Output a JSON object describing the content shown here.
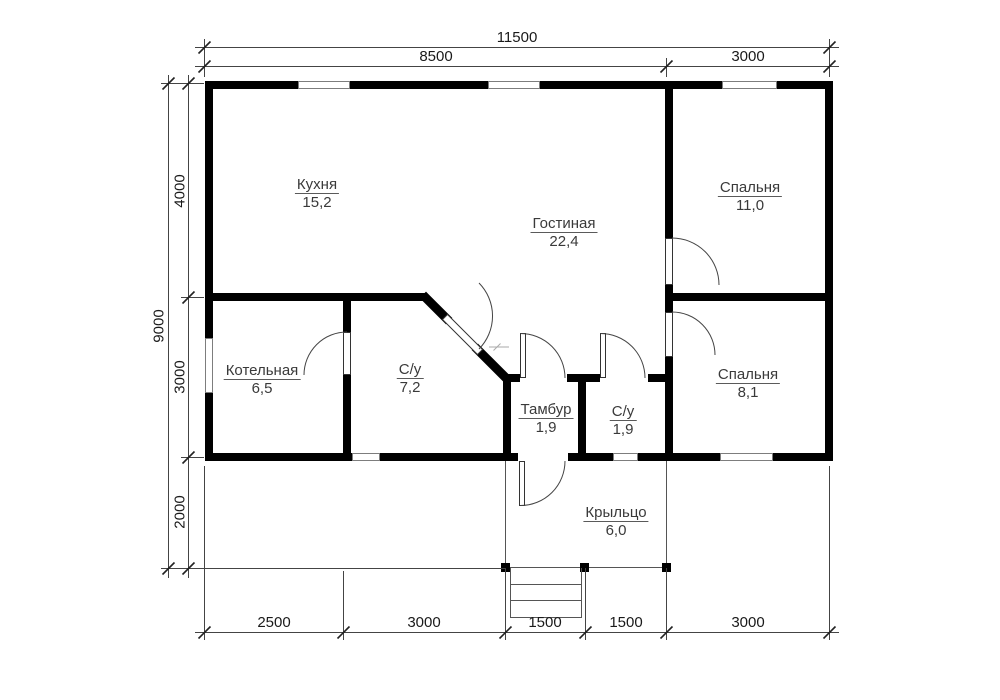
{
  "plan": {
    "rooms": [
      {
        "id": "kitchen",
        "name": "Кухня",
        "area": "15,2"
      },
      {
        "id": "living",
        "name": "Гостиная",
        "area": "22,4"
      },
      {
        "id": "bedroom1",
        "name": "Спальня",
        "area": "11,0"
      },
      {
        "id": "boiler",
        "name": "Котельная",
        "area": "6,5"
      },
      {
        "id": "bath1",
        "name": "С/у",
        "area": "7,2"
      },
      {
        "id": "tambour",
        "name": "Тамбур",
        "area": "1,9"
      },
      {
        "id": "bath2",
        "name": "С/у",
        "area": "1,9"
      },
      {
        "id": "bedroom2",
        "name": "Спальня",
        "area": "8,1"
      },
      {
        "id": "porch",
        "name": "Крыльцо",
        "area": "6,0"
      }
    ],
    "dims": {
      "total_width": "11500",
      "width_segments": [
        "8500",
        "3000"
      ],
      "total_height": "9000",
      "height_segments": [
        "4000",
        "3000",
        "2000"
      ],
      "bottom_segments": [
        "2500",
        "3000",
        "1500",
        "1500",
        "3000"
      ]
    },
    "colors": {
      "wall": "#000000",
      "thin_line": "#444444",
      "text": "#3a3a3a"
    }
  }
}
